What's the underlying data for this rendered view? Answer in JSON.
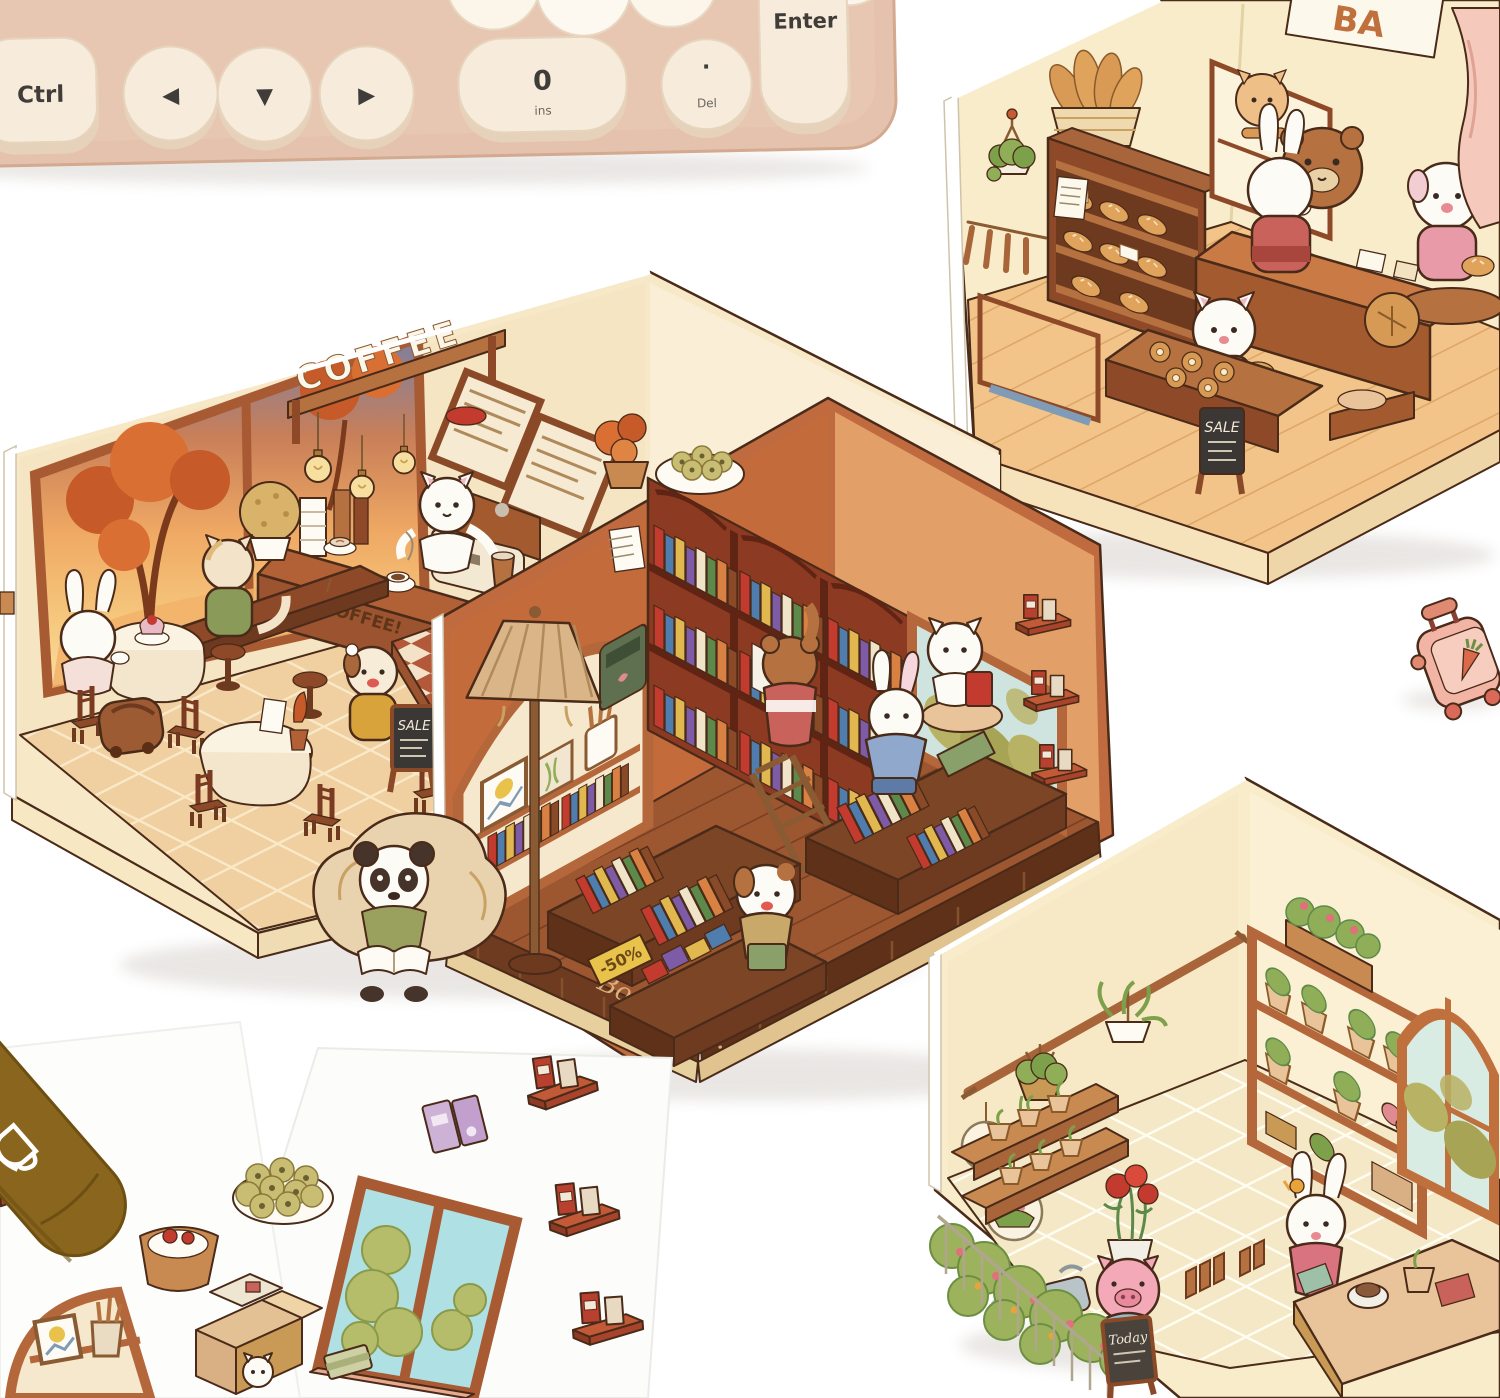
{
  "keyboard": {
    "keys": {
      "ctrl": "Ctrl",
      "arrow_left": "◀",
      "arrow_down": "▼",
      "arrow_right": "▶",
      "zero": "0",
      "zero_sub": "ins",
      "period": "·",
      "period_sub": "Del",
      "enter": "Enter"
    }
  },
  "dioramas": {
    "coffee_shop": {
      "wall_sign": "COFFEE",
      "counter_sign": "COFFEE!",
      "sale_board": "SALE"
    },
    "bakery": {
      "name_sign": "BA",
      "sale_board": "SALE"
    },
    "bookstore": {
      "front_sign": "Bookstore.",
      "discount_tag": "-50%"
    },
    "plant_shop": {
      "chalkboard": "Today"
    }
  },
  "marker_pen": {
    "printed_text": "·Be"
  },
  "palette": {
    "background": "#ffffff",
    "keyboard_body": "#e5c2ad",
    "keycap": "#f7ecdb",
    "line_art_outline": "#4a2a18",
    "wall_cream": "#f8ecca",
    "wood_light": "#e9b77f",
    "wood_mid": "#b5713f",
    "wood_dark": "#8e4a28",
    "shelf_red_brown": "#8c3b22",
    "floor_tan": "#f0cfa0",
    "plant_green": "#8fae57",
    "sunset_orange": "#e8833a",
    "pig_pink": "#f2a7b6",
    "curtain_pink": "#f5cabc",
    "marker_olive": "#8a651e",
    "suitcase_pink": "#f2b4a4"
  }
}
